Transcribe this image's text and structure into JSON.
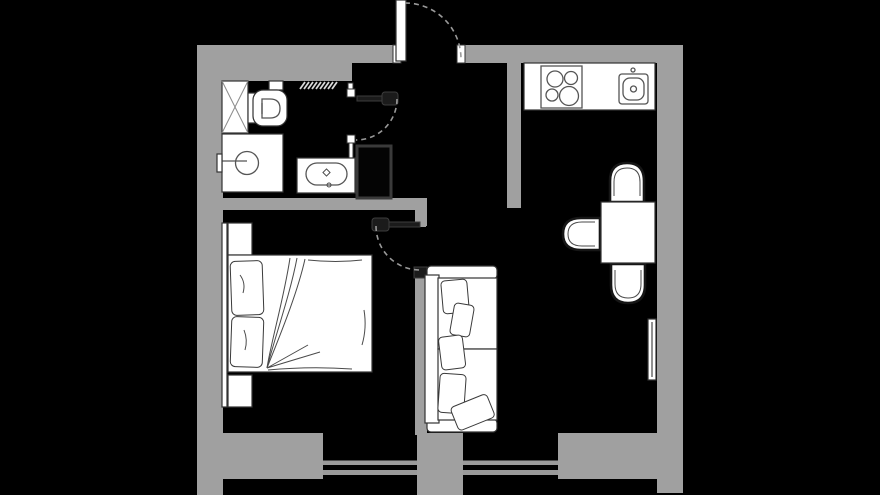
{
  "app": {
    "title": "apartment-floor-plan"
  },
  "colors": {
    "bg": "#000000",
    "wall": "#a0a0a0",
    "white": "#ffffff",
    "line": "#333333",
    "detail": "#555555",
    "leaf": "#1b1b1b",
    "leafline": "#3d3d3d",
    "arc": "#999999",
    "glass": "#9a9a9a",
    "shaft": "#3a3a3a"
  },
  "plan": {
    "rooms": [
      {
        "name": "bathroom",
        "position": "top-left"
      },
      {
        "name": "hallway",
        "position": "top-center"
      },
      {
        "name": "bedroom",
        "position": "left"
      },
      {
        "name": "living-room",
        "position": "center-right"
      },
      {
        "name": "kitchen-dining-area",
        "position": "right"
      }
    ],
    "doors": [
      {
        "name": "entrance-door",
        "wall": "north",
        "swing": "outward",
        "leaf": "white"
      },
      {
        "name": "bathroom-door",
        "wall": "bathroom-partition",
        "swing": "into-hallway",
        "leaf": "dark"
      },
      {
        "name": "bedroom-door",
        "wall": "bedroom-divider",
        "swing": "into-bedroom",
        "leaf": "dark"
      }
    ],
    "windows": [
      {
        "name": "window-left",
        "wall": "south",
        "panes": 1
      },
      {
        "name": "window-right",
        "wall": "south",
        "panes": 1
      }
    ],
    "fixtures": {
      "bathroom": [
        "shower-tray",
        "toilet",
        "flush-plate",
        "towel-radiator",
        "washing-machine",
        "vanity-sink"
      ],
      "kitchen": [
        "counter",
        "cooktop",
        "kitchen-sink",
        "faucet"
      ],
      "cooktop_burners": 4,
      "dining": [
        "square-table",
        "chairs",
        "wall-radiator"
      ],
      "dining_chairs": 3,
      "bedroom": [
        "double-bed",
        "bed-pillows",
        "blanket",
        "nightstand-north",
        "nightstand-south",
        "headboard-trim"
      ],
      "bedroom_pillows": 2,
      "living": [
        "sofa",
        "seat-cushions",
        "scatter-pillows"
      ],
      "sofa_scatter_pillows": 5,
      "utility": [
        "ventilation-shaft"
      ]
    }
  }
}
